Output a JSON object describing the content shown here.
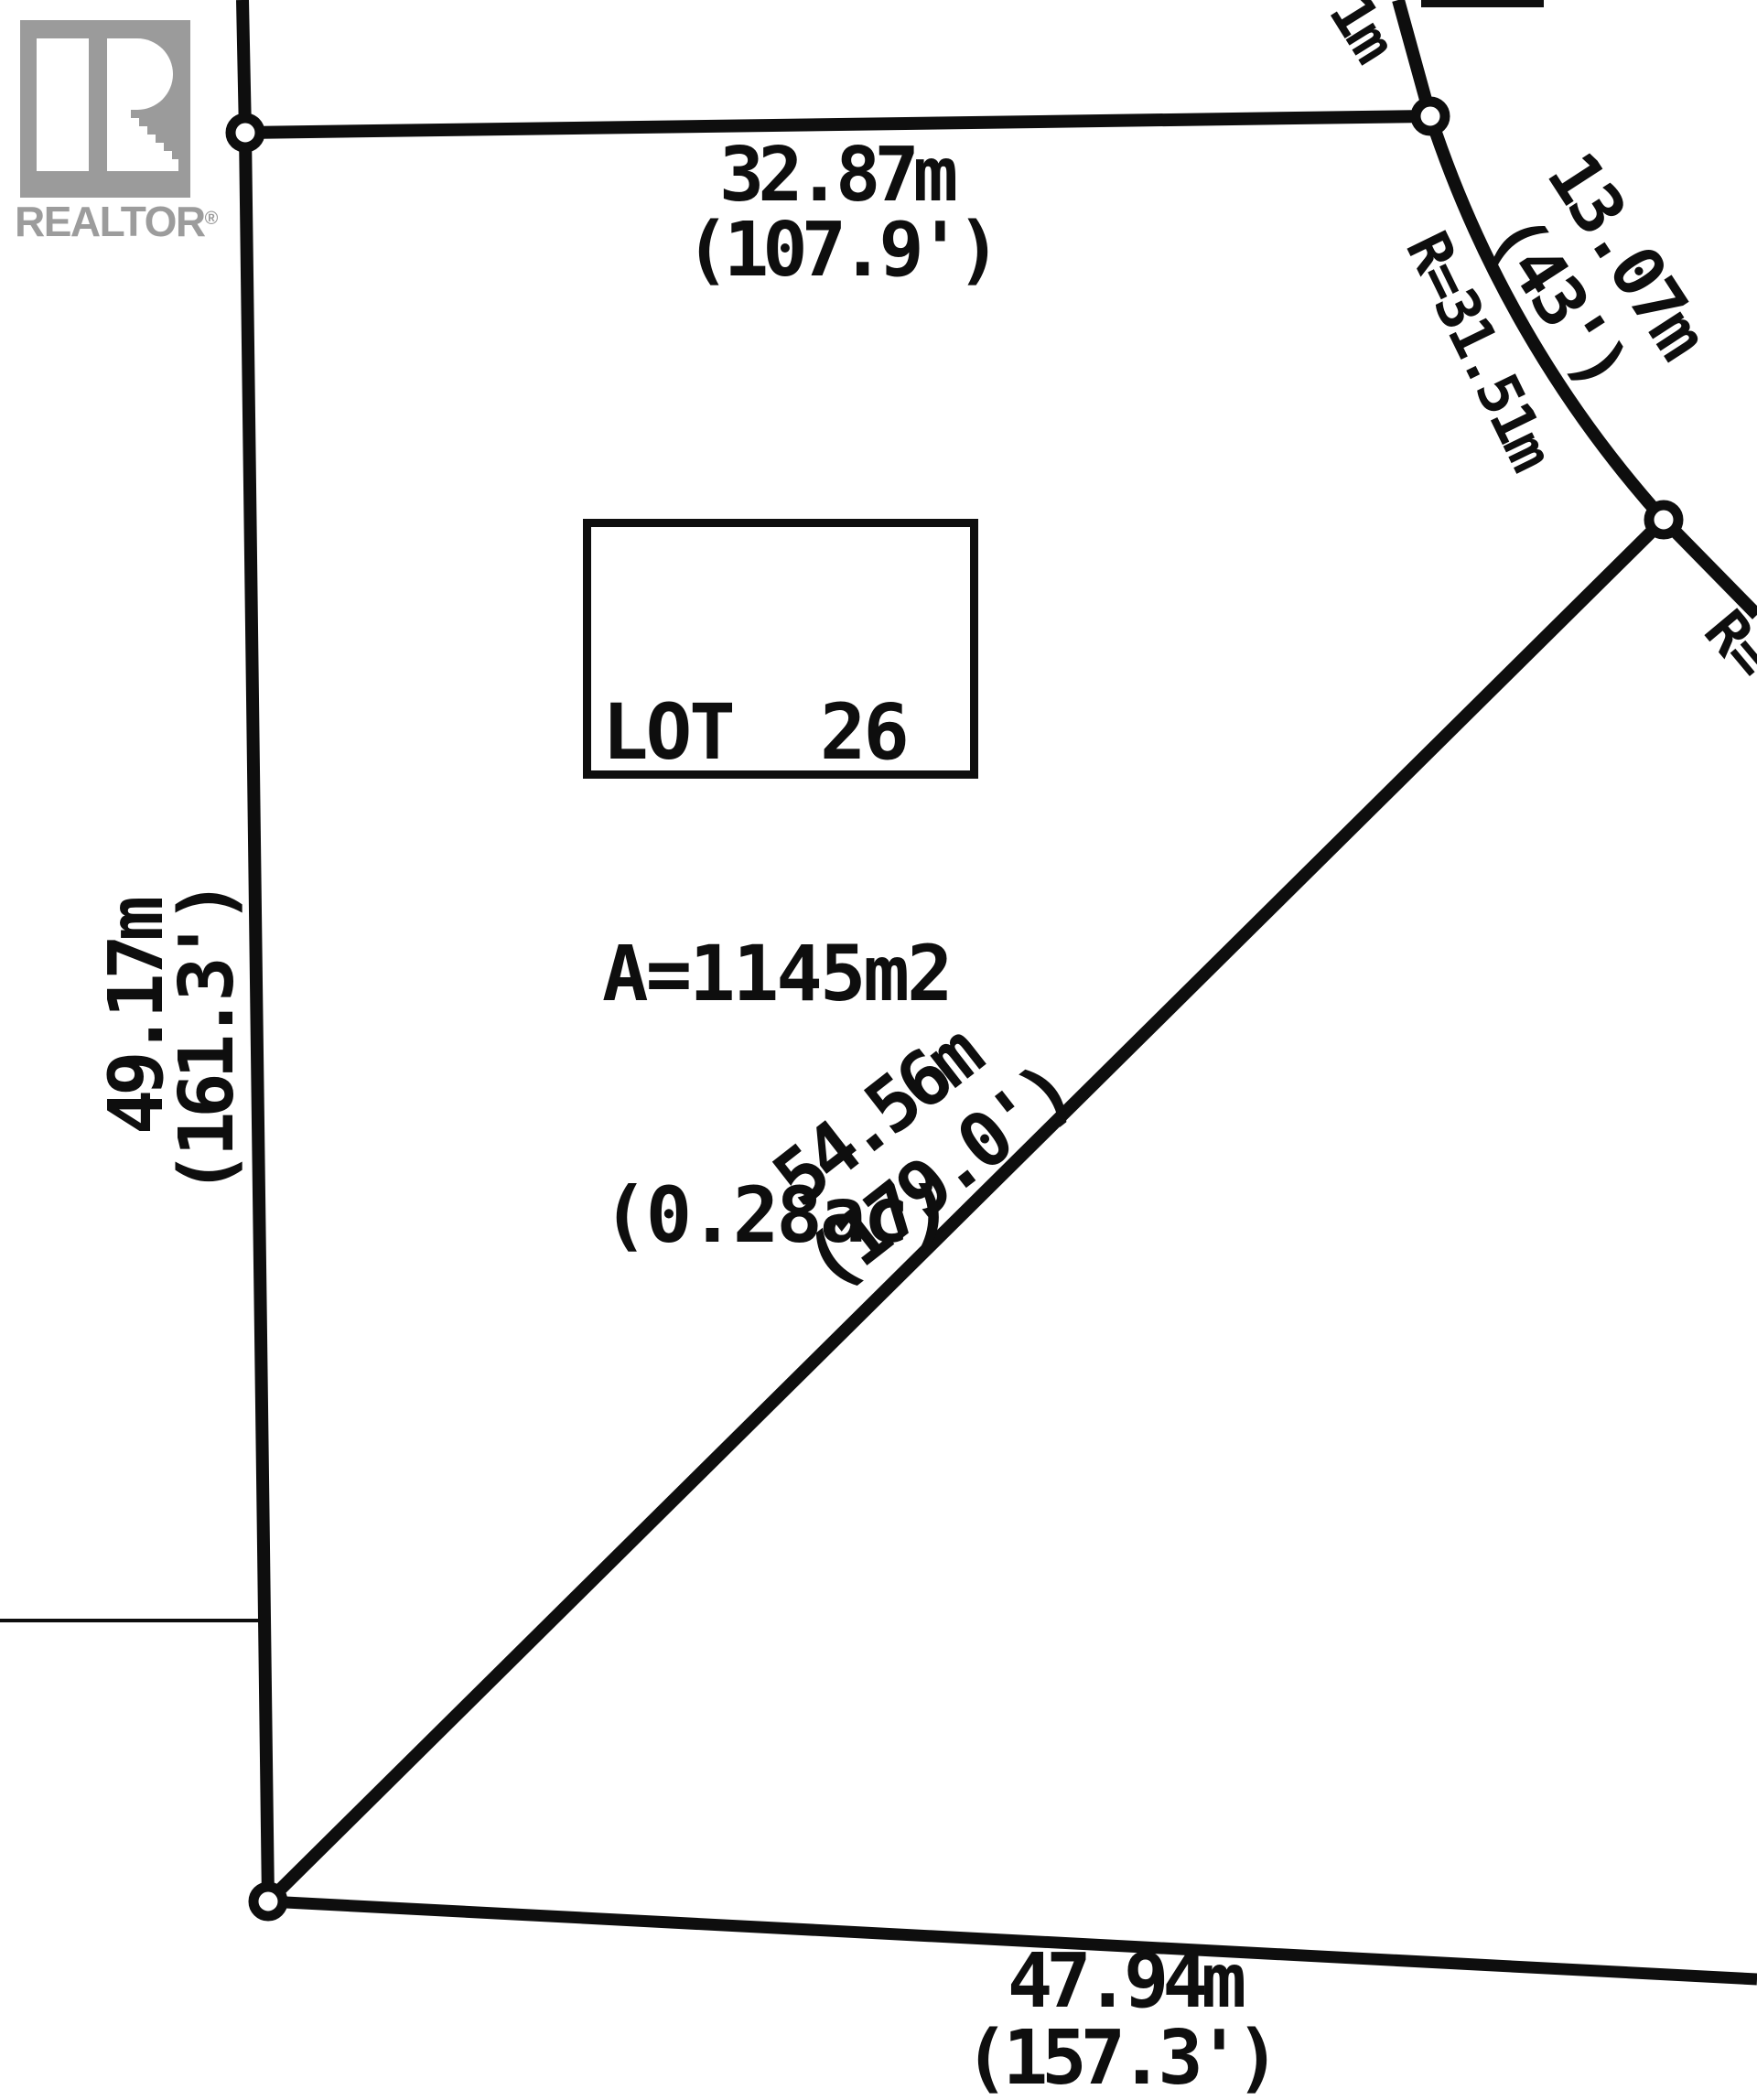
{
  "branding": {
    "realtor_text": "REALTOR",
    "registered_mark": "®"
  },
  "lot_label": {
    "title": "LOT  26",
    "area_metric": "A=1145m2",
    "area_imperial": "(0.28ac)"
  },
  "dimensions": {
    "top_metric": "32.87m",
    "top_imperial": "(107.9')",
    "left_metric": "49.17m",
    "left_imperial": "(161.3')",
    "diagonal_metric": "54.56m",
    "diagonal_imperial": "(179.0')",
    "bottom_metric": "47.94m",
    "bottom_imperial": "(157.3')",
    "curve_metric": "13.07m",
    "curve_imperial": "(43')",
    "radius_curve": "R=31.51m",
    "radius_right_partial": "R=",
    "top_edge_partial": "1m"
  },
  "colors": {
    "line": "#0e0e0e",
    "logo_gray": "#9b9b9b",
    "background": "#ffffff"
  }
}
